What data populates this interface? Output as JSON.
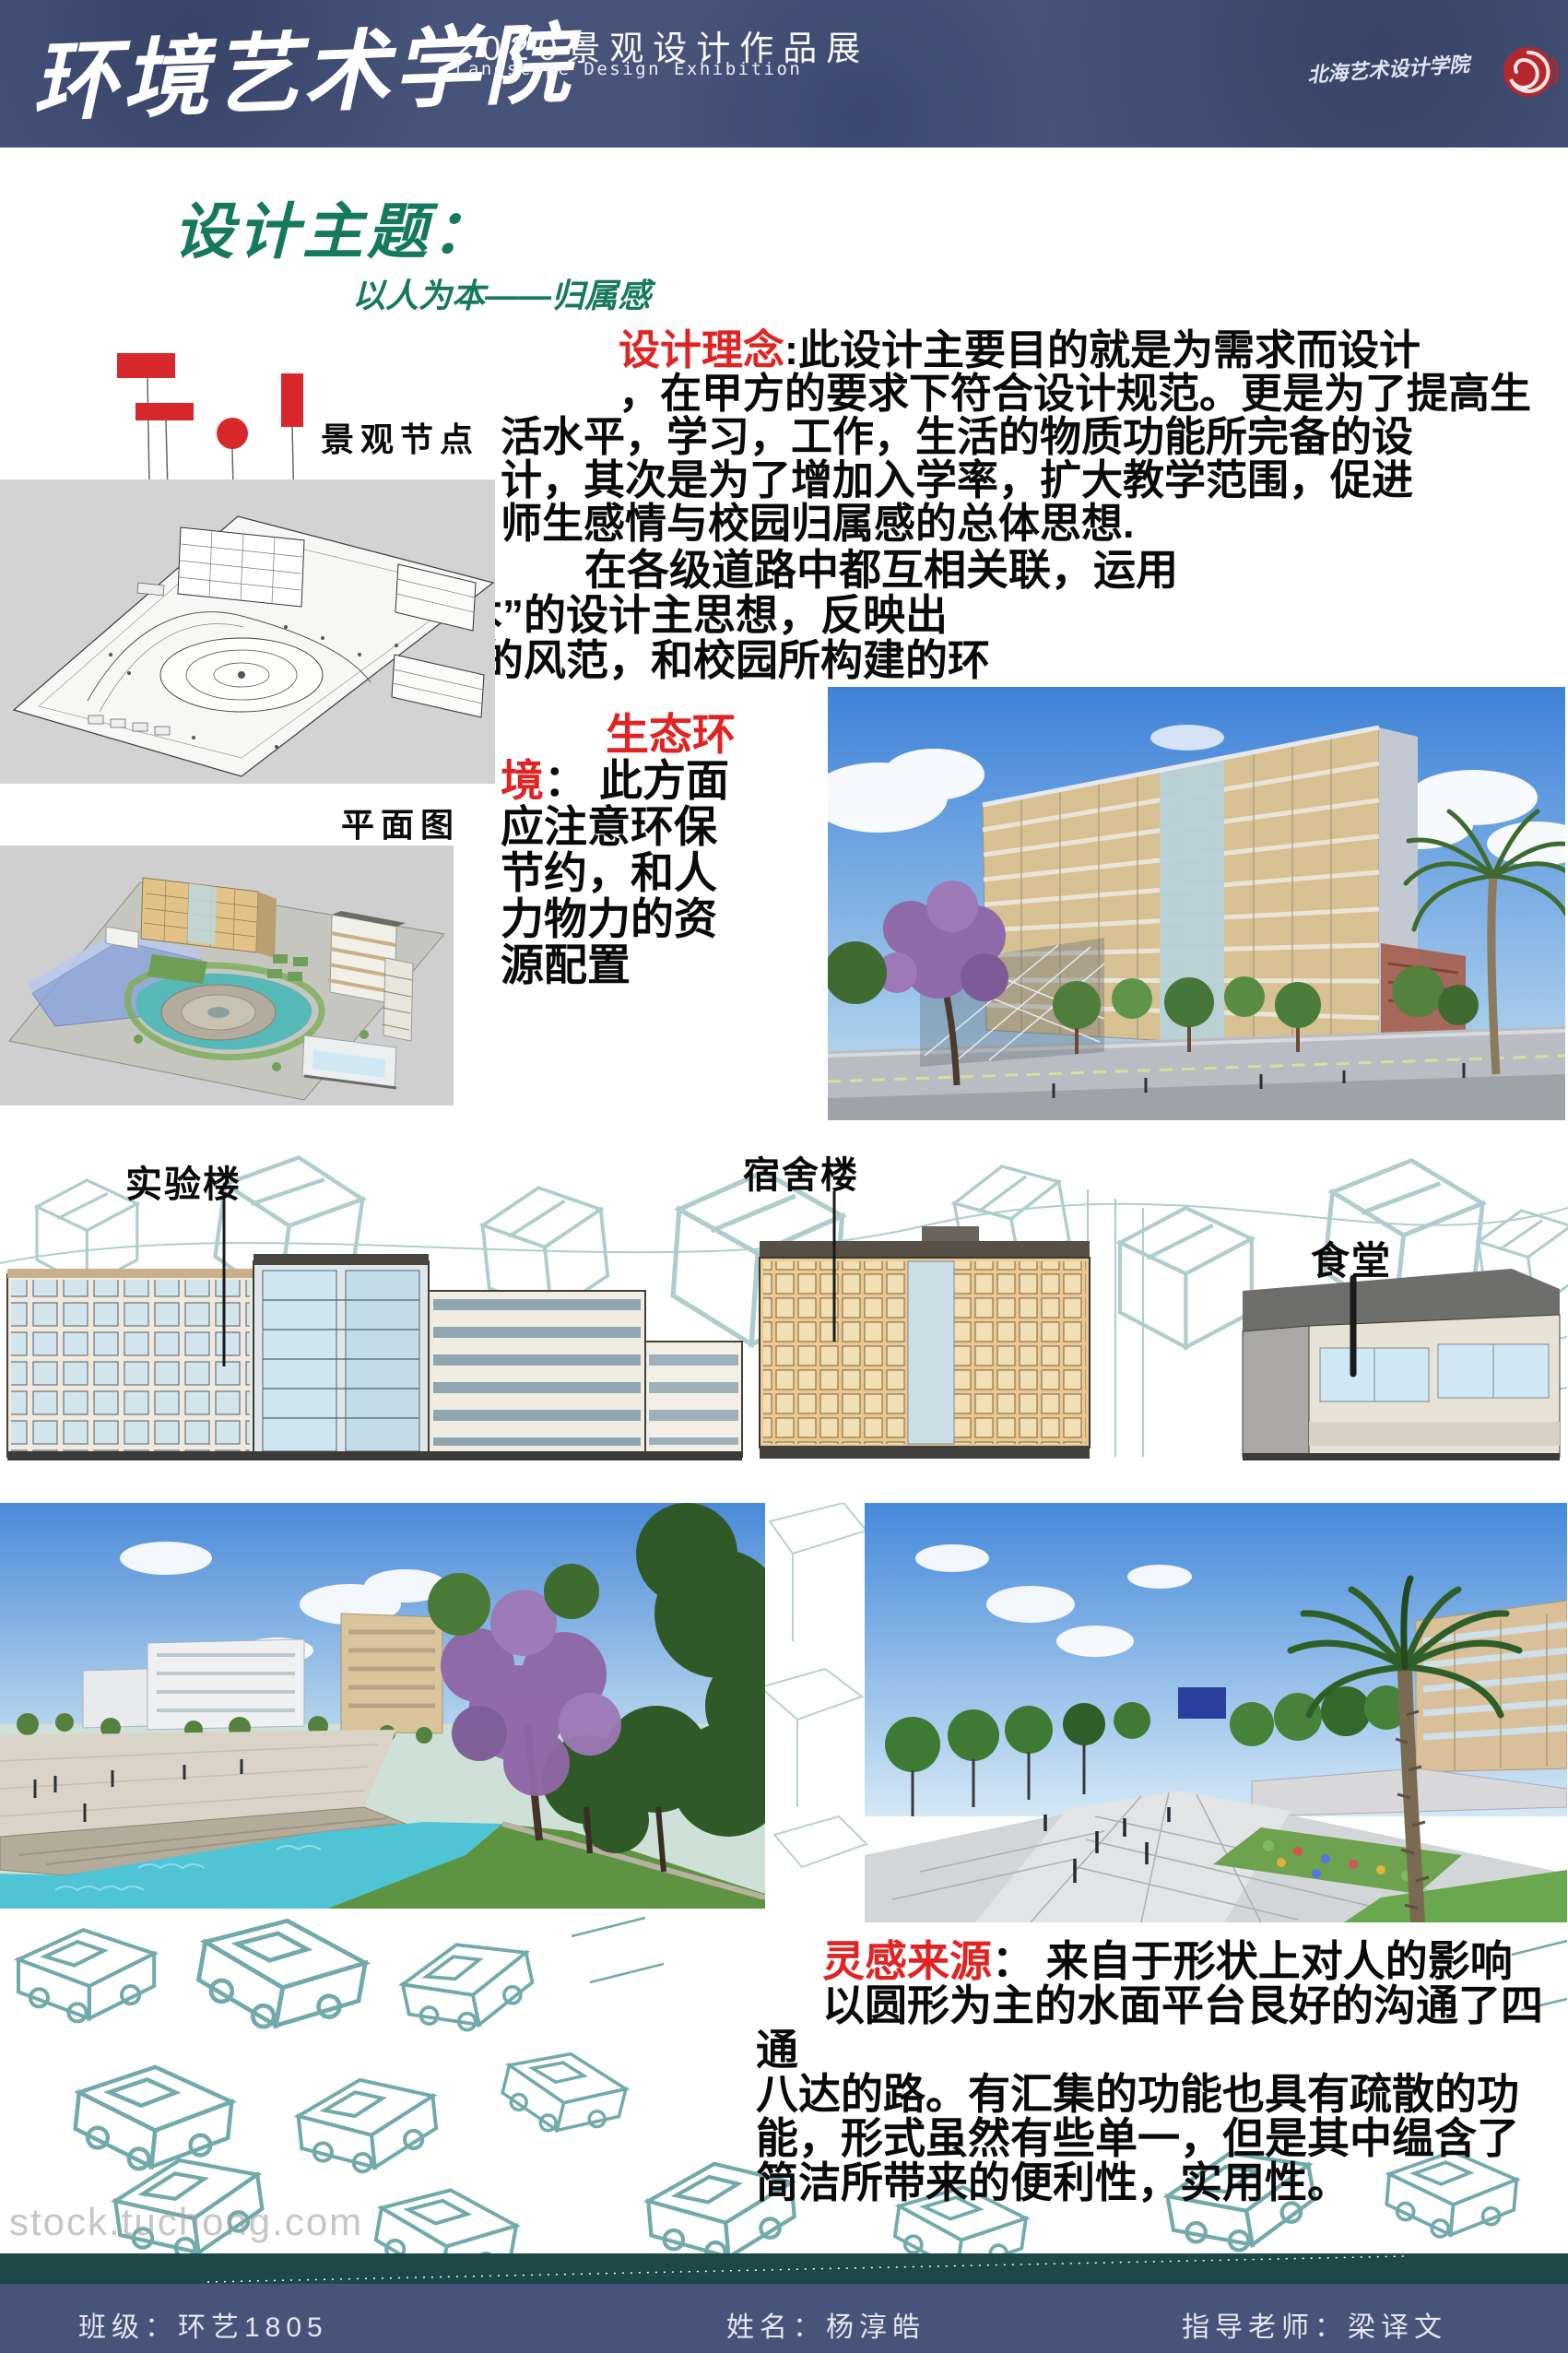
{
  "header": {
    "school_name": "环境艺术学院",
    "exhibition_title": "2020景观设计作品展",
    "exhibition_subtitle": "Landscape Design Exhibition",
    "institute_signature": "北海艺术设计学院"
  },
  "theme": {
    "title": "设计主题：",
    "subtitle": "以人为本——归属感"
  },
  "concept": {
    "label": "设计理念",
    "colon": ":",
    "first_line": "此设计主要目的就是为需求而设计",
    "lines": [
      "，在甲方的要求下符合设计规范。更是为了提高生",
      "活水平，学习，工作，生活的物质功能所完备的设",
      "计，其次是为了增加入学率，扩大教学范围，促进",
      "师生感情与校园归属感的总体思想."
    ]
  },
  "connection": {
    "lines": [
      "在各级道路中都互相关联，运用",
      "“以人为本”的设计主思想，反映出",
      "学校应有的风范，和校园所构建的环",
      "境"
    ]
  },
  "eco": {
    "label_line1": "生态环",
    "label_line2": "境",
    "colon": "：",
    "first_rest": " 此方面",
    "lines": [
      "应注意环保",
      "节约，和人",
      "力物力的资",
      "源配置"
    ]
  },
  "figures": {
    "nodes_label": "景观节点",
    "plan_label": "平面图",
    "lab_label": "实验楼",
    "dorm_label": "宿舍楼",
    "canteen_label": "食堂"
  },
  "inspiration": {
    "label": "灵感来源",
    "colon": "：",
    "first_line": " 来自于形状上对人的影响",
    "lines": [
      "以圆形为主的水面平台艮好的沟通了四通",
      "八达的路。有汇集的功能也具有疏散的功",
      "能，形式虽然有些单一，但是其中缊含了",
      "简洁所带来的便利性，实用性。"
    ]
  },
  "watermark": "stock.tuchong.com",
  "footer": {
    "class_field": "班级：环艺1805",
    "name_field": "姓名：杨淳皓",
    "advisor_field": "指导老师：梁译文"
  },
  "colors": {
    "accent_red": "#d9282b",
    "title_green": "#16795e",
    "band_blue": "#475379",
    "band_teal": "#1e4747",
    "sketch_teal": "#5e9fa0"
  }
}
